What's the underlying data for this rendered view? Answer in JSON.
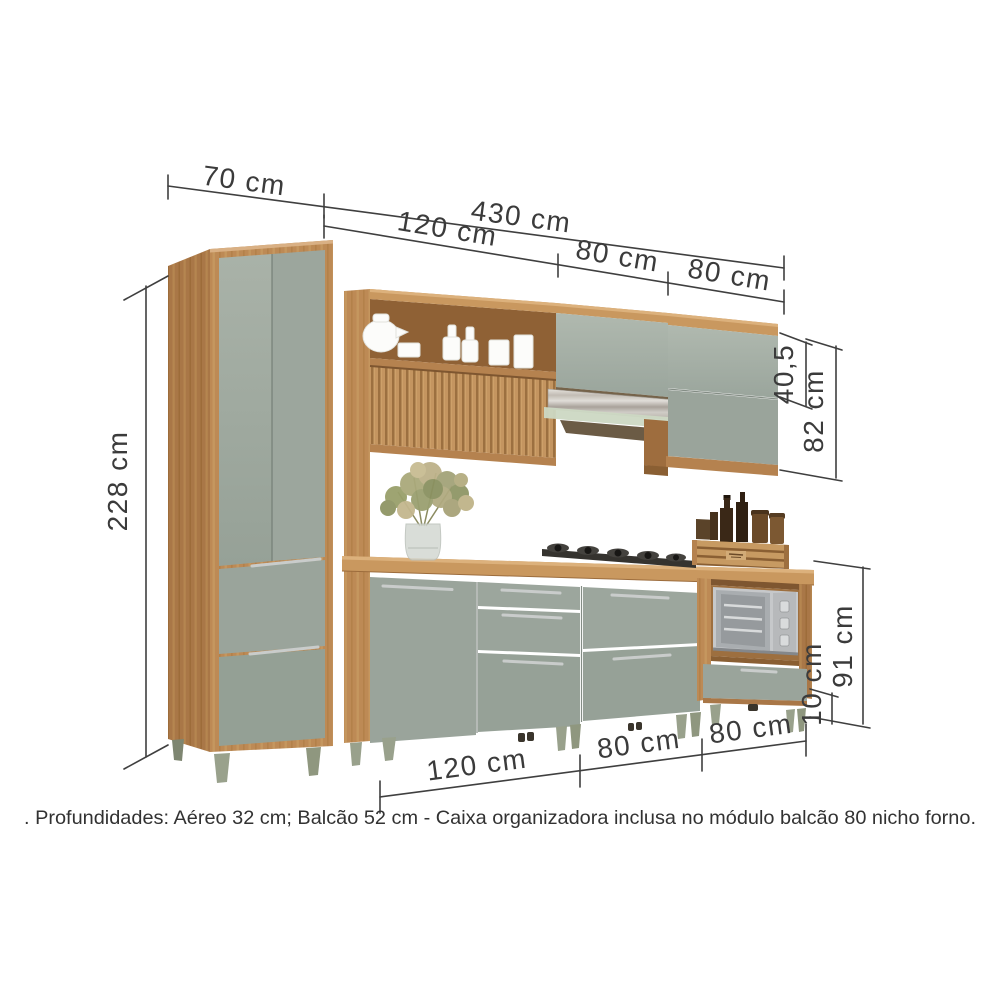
{
  "product_diagram": {
    "dimensions": {
      "top_width_left": "70 cm",
      "top_width_total": "430 cm",
      "upper_modules": [
        "120 cm",
        "80 cm",
        "80 cm"
      ],
      "left_total_height": "228 cm",
      "upper_right_door_height": "40,5",
      "upper_right_total_height": "82 cm",
      "base_modules": [
        "120 cm",
        "80 cm",
        "80 cm"
      ],
      "base_right_total_height": "91 cm",
      "feet_height": "10 cm"
    },
    "note": ". Profundidades: Aéreo 32 cm; Balcão 52 cm - Caixa organizadora inclusa no módulo balcão 80 nicho forno.",
    "colors": {
      "background": "#ffffff",
      "wood": "#bd8a55",
      "wood_dark": "#a97747",
      "wood_band": "#c9985f",
      "door_green": "#9aa49b",
      "dimension_text": "#3b3b3b"
    }
  }
}
